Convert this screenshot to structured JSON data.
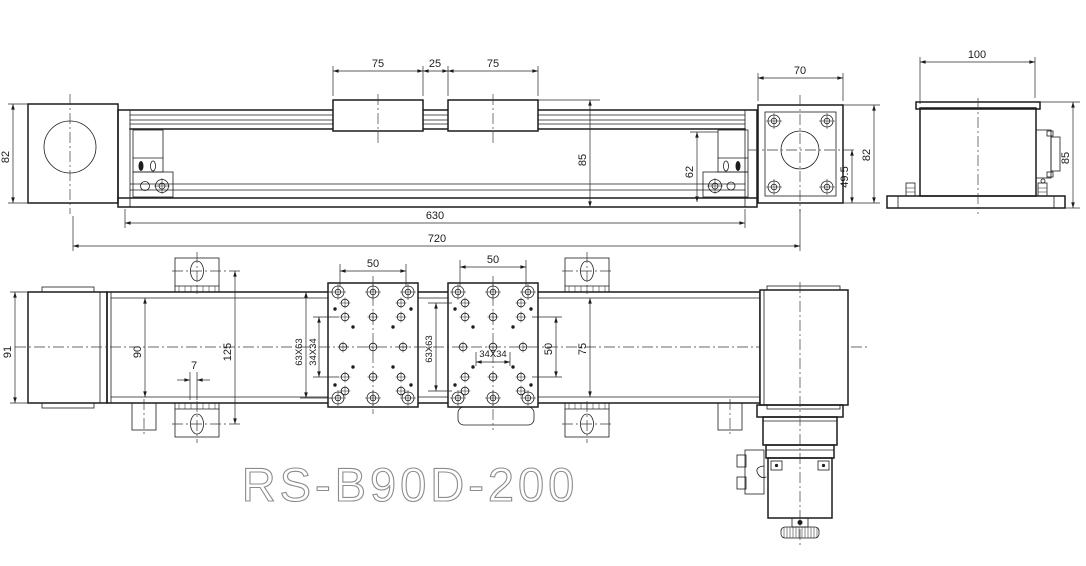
{
  "title": "RS-B90D-200",
  "colors": {
    "line": "#1c1c1c",
    "title": "#8c8c8c",
    "background": "#ffffff"
  },
  "views": {
    "front": {
      "dims": {
        "carriage1_width": "75",
        "carriage_gap": "25",
        "carriage2_width": "75",
        "end_block_height": "82",
        "overall_height": "85",
        "inner_height": "62",
        "base_length": "630",
        "overall_length": "720"
      }
    },
    "flange_end": {
      "dims": {
        "width": "70",
        "center_height": "49.5",
        "height": "82"
      }
    },
    "motor_side": {
      "dims": {
        "width": "100",
        "height": "85"
      }
    },
    "plan": {
      "dims": {
        "end_cap_width": "91",
        "body_width": "90",
        "foot_span": "125",
        "foot_offset": "7",
        "plate1_hole_spacing": "50",
        "plate1_pattern": "63X63",
        "plate1_inner_pattern": "34X34",
        "plate2_hole_spacing": "50",
        "plate2_pattern": "63X63",
        "plate2_inner_pattern": "34X34",
        "plate2_row_spacing": "50",
        "rail_width": "75"
      }
    }
  }
}
